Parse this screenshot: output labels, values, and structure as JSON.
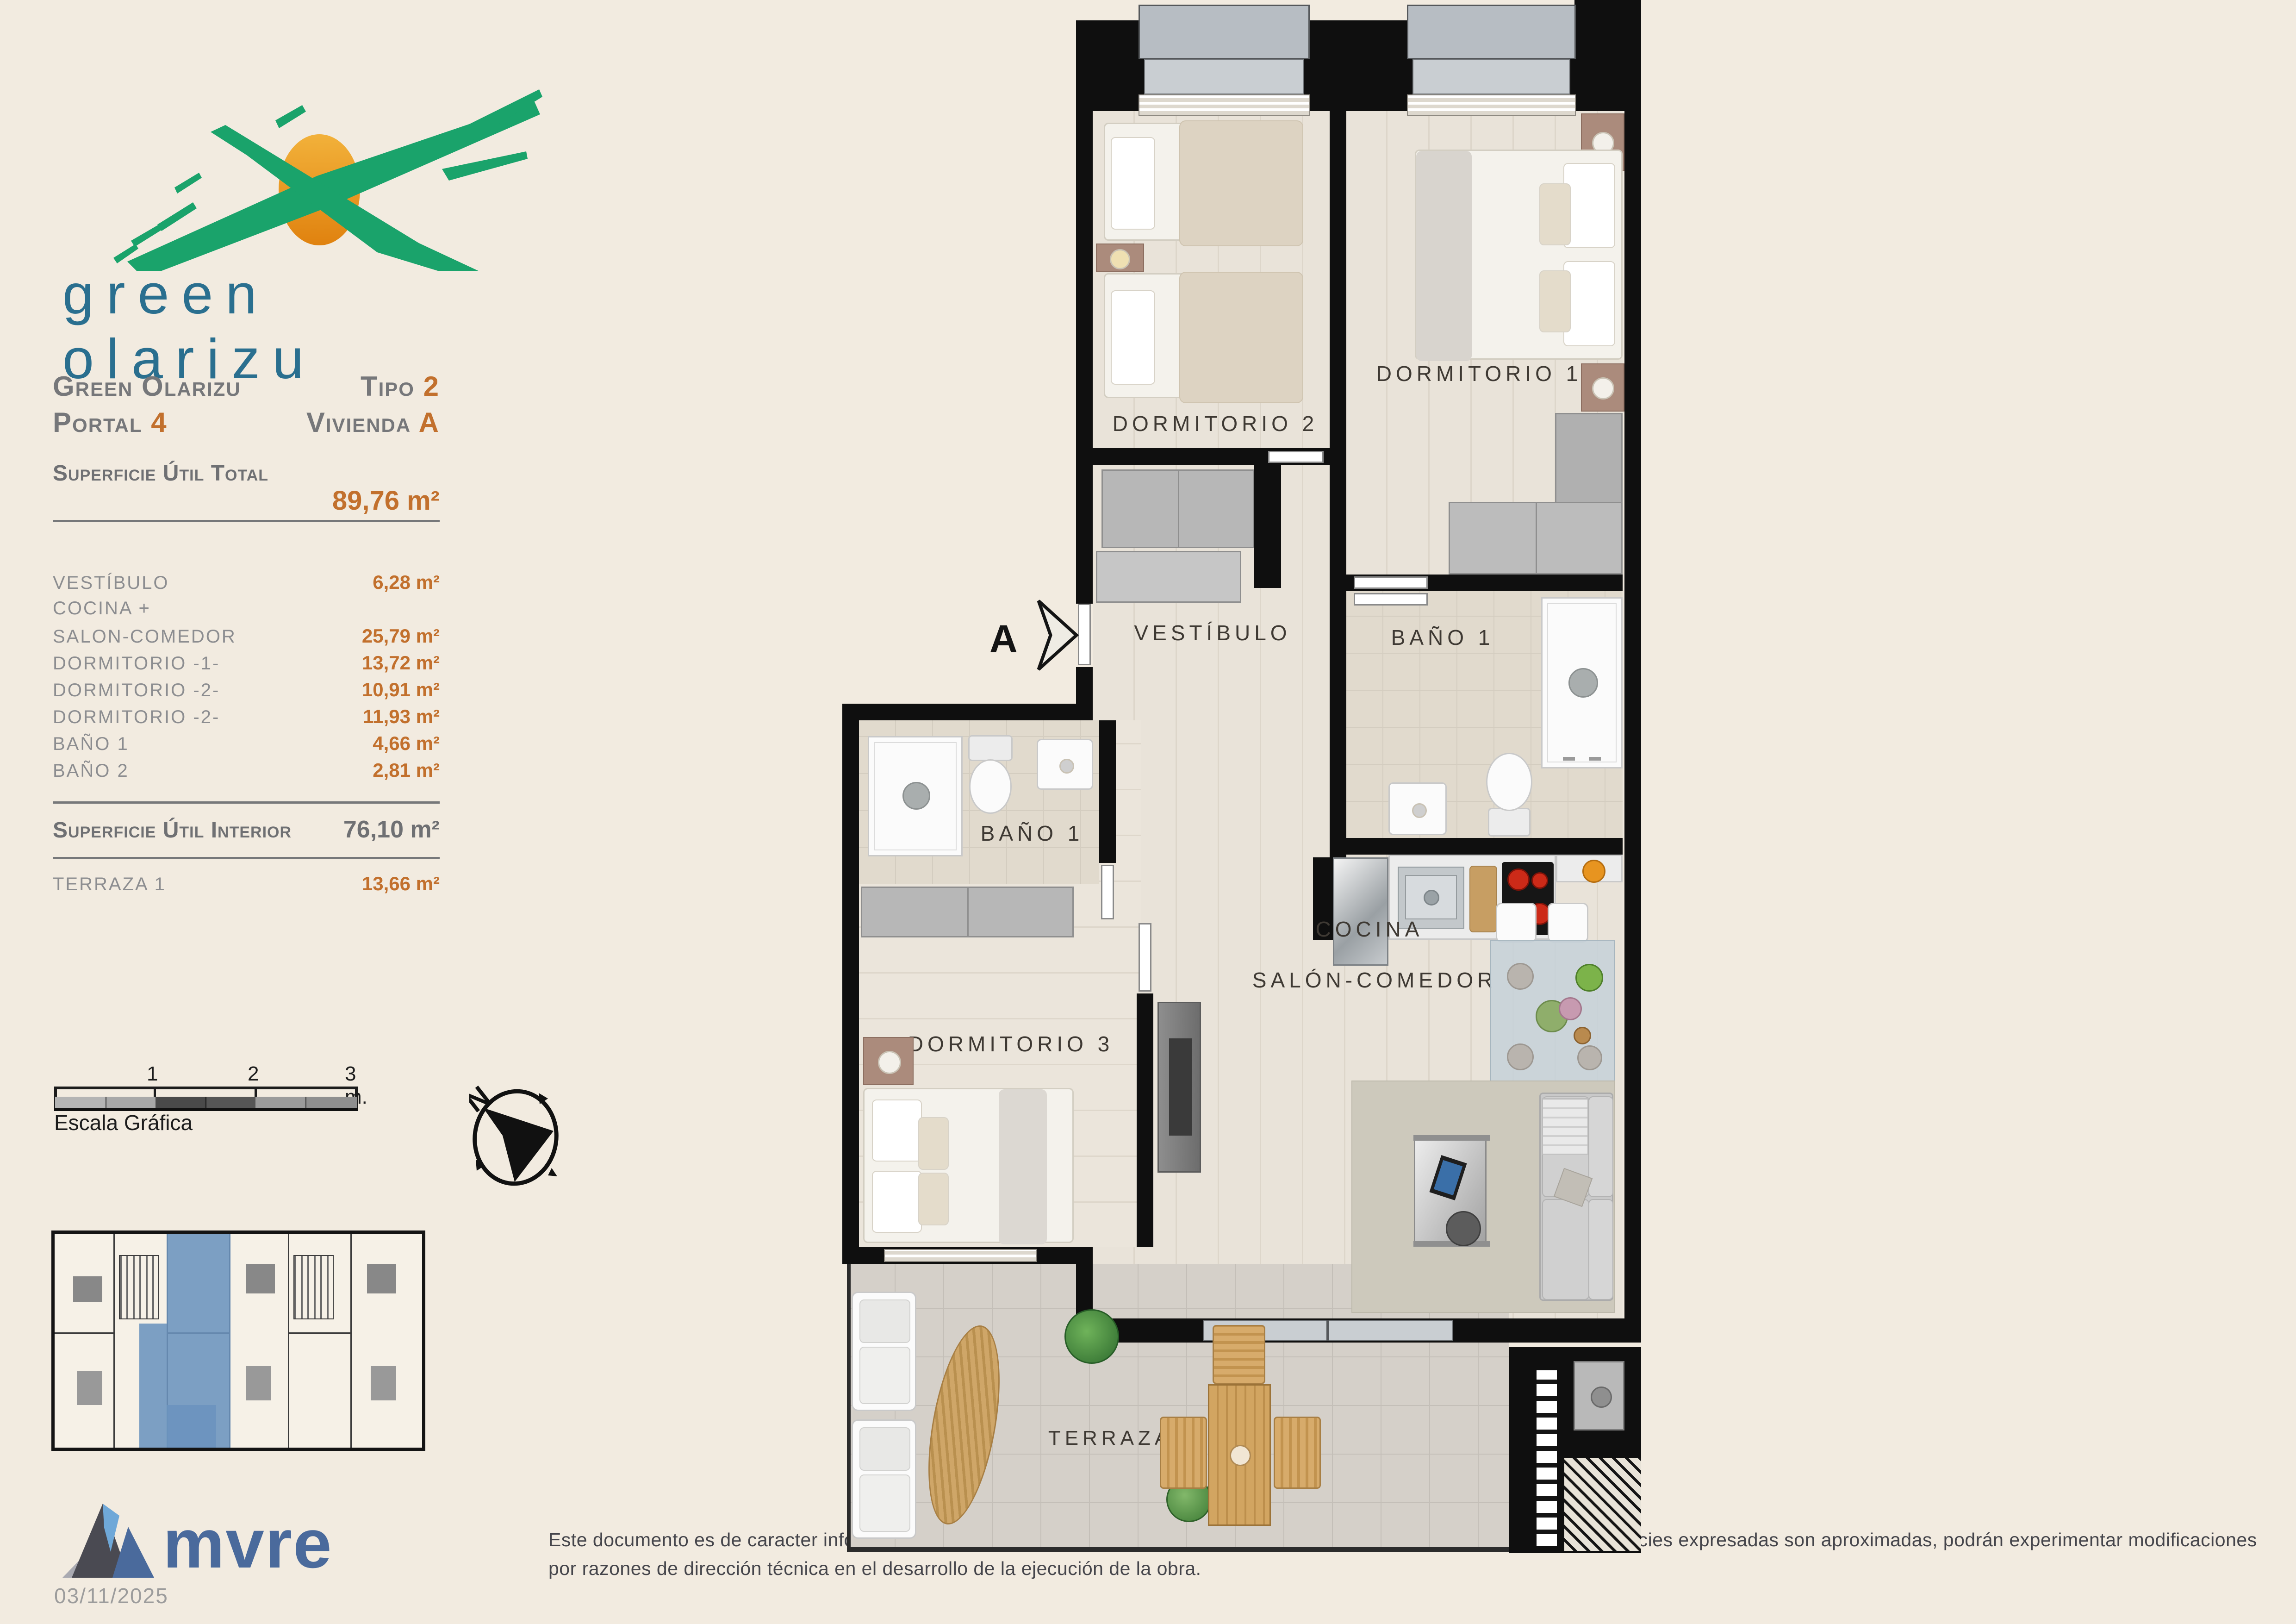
{
  "logo": {
    "brand_text": "green olarizu"
  },
  "title": {
    "project": "Green Olarizu",
    "tipo_label": "Tipo",
    "tipo_value": "2",
    "portal_label": "Portal",
    "portal_value": "4",
    "vivienda_label": "Vivienda",
    "vivienda_value": "A"
  },
  "summary": {
    "total_label": "Superficie Útil Total",
    "total_value": "89,76 m²",
    "interior_label": "Superficie Útil Interior",
    "interior_value": "76,10 m²",
    "terraza_label": "TERRAZA 1",
    "terraza_value": "13,66 m²"
  },
  "rooms": [
    {
      "label": "VESTÍBULO",
      "value": "6,28 m²"
    },
    {
      "label": "COCINA +",
      "value": ""
    },
    {
      "label": "SALON-COMEDOR",
      "value": "25,79 m²"
    },
    {
      "label": "DORMITORIO -1-",
      "value": "13,72 m²"
    },
    {
      "label": "DORMITORIO -2-",
      "value": "10,91 m²"
    },
    {
      "label": "DORMITORIO -2-",
      "value": "11,93 m²"
    },
    {
      "label": "BAÑO 1",
      "value": "4,66 m²"
    },
    {
      "label": "BAÑO 2",
      "value": "2,81 m²"
    }
  ],
  "scale_bar": {
    "tick1": "1",
    "tick2": "2",
    "tick3": "3 m.",
    "caption": "Escala Gráfica"
  },
  "compass": {
    "north_label": "N"
  },
  "plan": {
    "labels": {
      "dorm2": "DORMITORIO 2",
      "dorm1": "DORMITORIO 1",
      "vestibulo": "VESTÍBULO",
      "bano_right": "BAÑO 1",
      "bano_left": "BAÑO 1",
      "cocina": "COCINA",
      "salon": "SALÓN-COMEDOR",
      "dorm3": "DORMITORIO 3",
      "terraza": "TERRAZA",
      "entrance_letter": "A"
    }
  },
  "footer": {
    "brand": "mvre",
    "date": "03/11/2025",
    "disclaimer": "Este documento es de caracter informativo y podrá experimentar variaciones por exigencias técnicas del proyecto. Las superficies expresadas son aproximadas, podrán experimentar modificaciones por razones de dirección técnica en el desarrollo de la ejecución de la obra."
  },
  "colors": {
    "background": "#f2ebe0",
    "accent_orange": "#c2702d",
    "logo_green": "#1aa36b",
    "logo_sun": "#eda01e",
    "logo_text_blue": "#2a6f8f",
    "mvre_blue": "#4a6a9c",
    "keyplan_highlight": "#6b93be",
    "wall_black": "#0f0f0f"
  }
}
